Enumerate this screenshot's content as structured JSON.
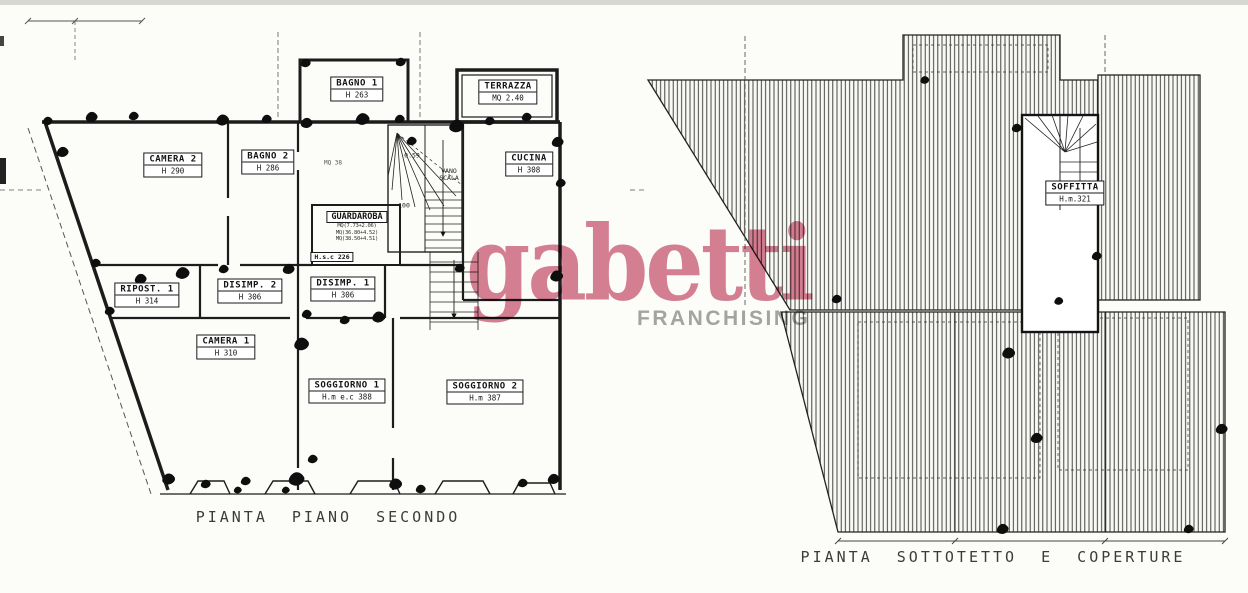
{
  "watermark": {
    "brand": "gabetti",
    "subtitle": "FRANCHISING",
    "brand_color": "#d3748c",
    "subtitle_color": "#9b9b9b"
  },
  "plans": {
    "secondo": {
      "title": "PIANTA PIANO SECONDO",
      "rooms": {
        "camera2": {
          "name": "CAMERA 2",
          "detail": "H 290"
        },
        "bagno2": {
          "name": "BAGNO 2",
          "detail": "H 286"
        },
        "bagno1": {
          "name": "BAGNO 1",
          "detail": "H 263"
        },
        "terrazza": {
          "name": "TERRAZZA",
          "detail": "MQ 2.40"
        },
        "cucina": {
          "name": "CUCINA",
          "detail": "H 308"
        },
        "guardaroba": {
          "name": "GUARDAROBA",
          "line1": "MQ(7.73+2.06)",
          "line2": "MQ(36.80+4.52)",
          "line3": "MQ(38.50+4.51)",
          "hsc": "H.s.c 226"
        },
        "ripost1": {
          "name": "RIPOST. 1",
          "detail": "H 314"
        },
        "disimp2": {
          "name": "DISIMP. 2",
          "detail": "H 306"
        },
        "disimp1": {
          "name": "DISIMP. 1",
          "detail": "H 306"
        },
        "camera1": {
          "name": "CAMERA 1",
          "detail": "H 310"
        },
        "soggiorno1": {
          "name": "SOGGIORNO 1",
          "detail": "H.m e.c 388"
        },
        "soggiorno2": {
          "name": "SOGGIORNO 2",
          "detail": "H.m 387"
        }
      },
      "annotations": {
        "vano_scala_1": "VANO",
        "vano_scala_2": "SCALA",
        "stair_level": "0.59",
        "dim_100": "100",
        "corridor_note": "MQ 38"
      }
    },
    "sottotetto": {
      "title": "PIANTA SOTTOTETTO E COPERTURE",
      "rooms": {
        "soffitta": {
          "name": "SOFFITTA",
          "detail": "H.m.321"
        }
      }
    }
  }
}
